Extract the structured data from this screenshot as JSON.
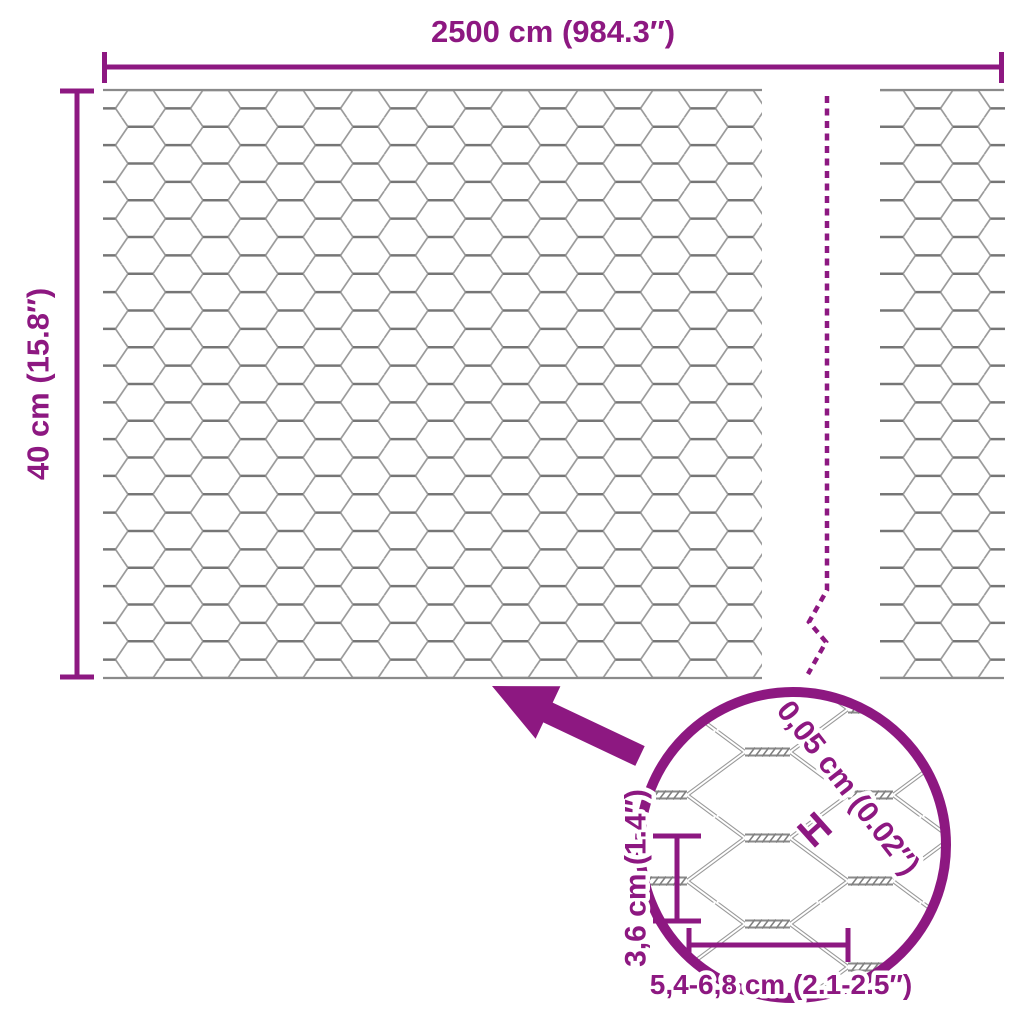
{
  "product_diagram": {
    "type": "hexagonal-wire-mesh-dimension-diagram",
    "accent_color": "#8D1881",
    "mesh_colors": {
      "diagonal_wire": "#9A9A9A",
      "twist_segment": "#757575",
      "edge_wire": "#8A8A8A",
      "detail_wire": "#8F8F8F"
    },
    "dimensions": {
      "roll_length": "2500 cm (984.3″)",
      "roll_height": "40 cm (15.8″)",
      "wire_thickness": "0,05 cm (0.02″)",
      "wire_thickness_marker": "H",
      "mesh_height": "3,6 cm (1.4″)",
      "mesh_width": "5,4-6,8 cm (2.1-2.5″)"
    }
  }
}
